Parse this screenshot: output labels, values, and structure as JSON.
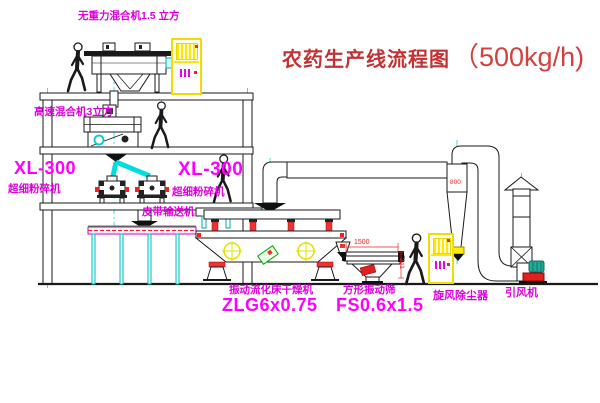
{
  "diagram": {
    "title": {
      "name": "农药生产线流程图",
      "capacity": "（500kg/h)"
    },
    "labels": {
      "gravity_mixer": "无重力混合机1.5 立方",
      "high_speed_mixer": "高速混合机3立方",
      "pulverizer_left": {
        "model": "XL-300",
        "name": "超细粉碎机"
      },
      "pulverizer_mid": {
        "model": "XL-300",
        "name": "超细粉碎机"
      },
      "belt_conveyor": "皮带输送机",
      "fluid_bed_dryer": {
        "name": "振动流化床干燥机",
        "model": "ZLG6x0.75"
      },
      "vibrating_screen": {
        "name": "方形振动筛",
        "model": "FS0.6x1.5"
      },
      "cyclone_collector": "旋风除尘器",
      "induced_draft_fan": "引风机"
    },
    "dimensions": {
      "screen_length": "1500",
      "screen_height": "341",
      "cyclone_dim": "800"
    },
    "colors": {
      "label_magenta": "#ff00ff",
      "label_magenta_dark": "#dd00dd",
      "title_red": "#cc3333",
      "centerline_cyan": "#00dddd",
      "cabinet_yellow": "#eedd00",
      "accent_red": "#ee2222",
      "vibration_marker_yellow": "#e3e300",
      "conveyor_green": "#00bb00",
      "fan_teal": "#22aa99"
    }
  }
}
